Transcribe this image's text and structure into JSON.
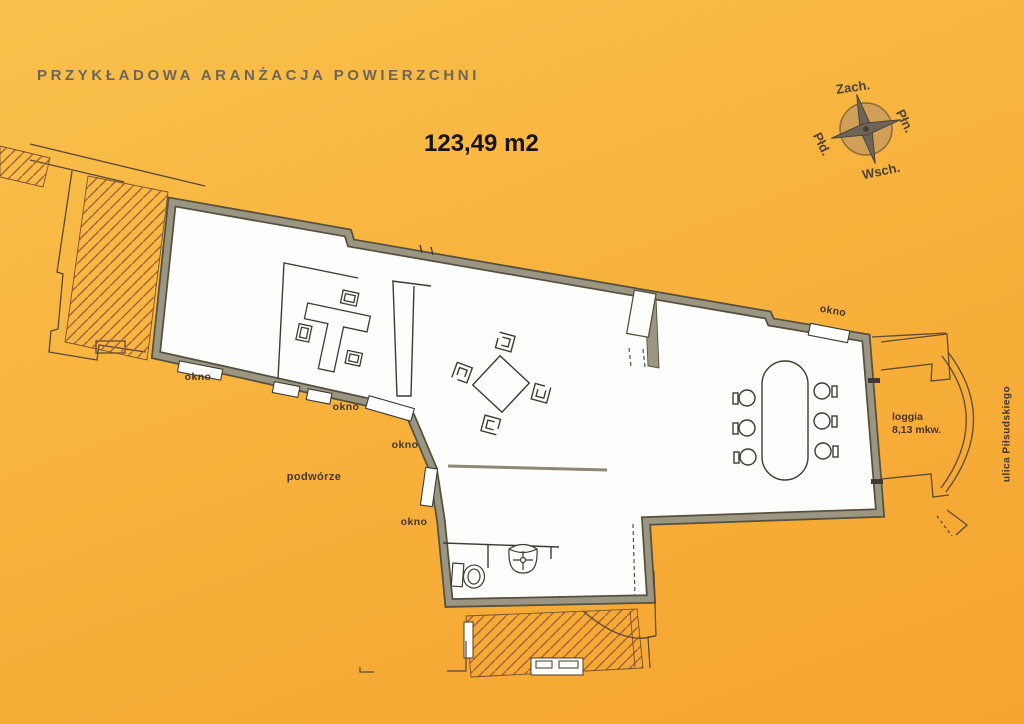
{
  "header": {
    "title": "PRZYKŁADOWA ARANŻACJA POWIERZCHNI",
    "total_area": "123,49 m2"
  },
  "compass": {
    "top": "Zach.",
    "right": "Płn.",
    "left": "Płd.",
    "bottom": "Wsch."
  },
  "plan_labels": {
    "windows": [
      "okno",
      "okno",
      "okno",
      "okno",
      "okno"
    ],
    "courtyard": "podwórze",
    "loggia_name": "loggia",
    "loggia_area": "8,13 mkw.",
    "street": "ulica Piłsudskiego"
  },
  "colors": {
    "background_top": "#f9c14c",
    "background_bottom": "#f5a42f",
    "wall_fill": "#9a9681",
    "wall_edge": "#55503f",
    "interior": "#fdfdfb",
    "thin_line": "#3f3b33",
    "neighbor_line": "#5a4733",
    "hatch": "#a5613e",
    "compass_disc": "#d0a058",
    "title_text": "#6b655c",
    "label_text": "#44362a"
  }
}
